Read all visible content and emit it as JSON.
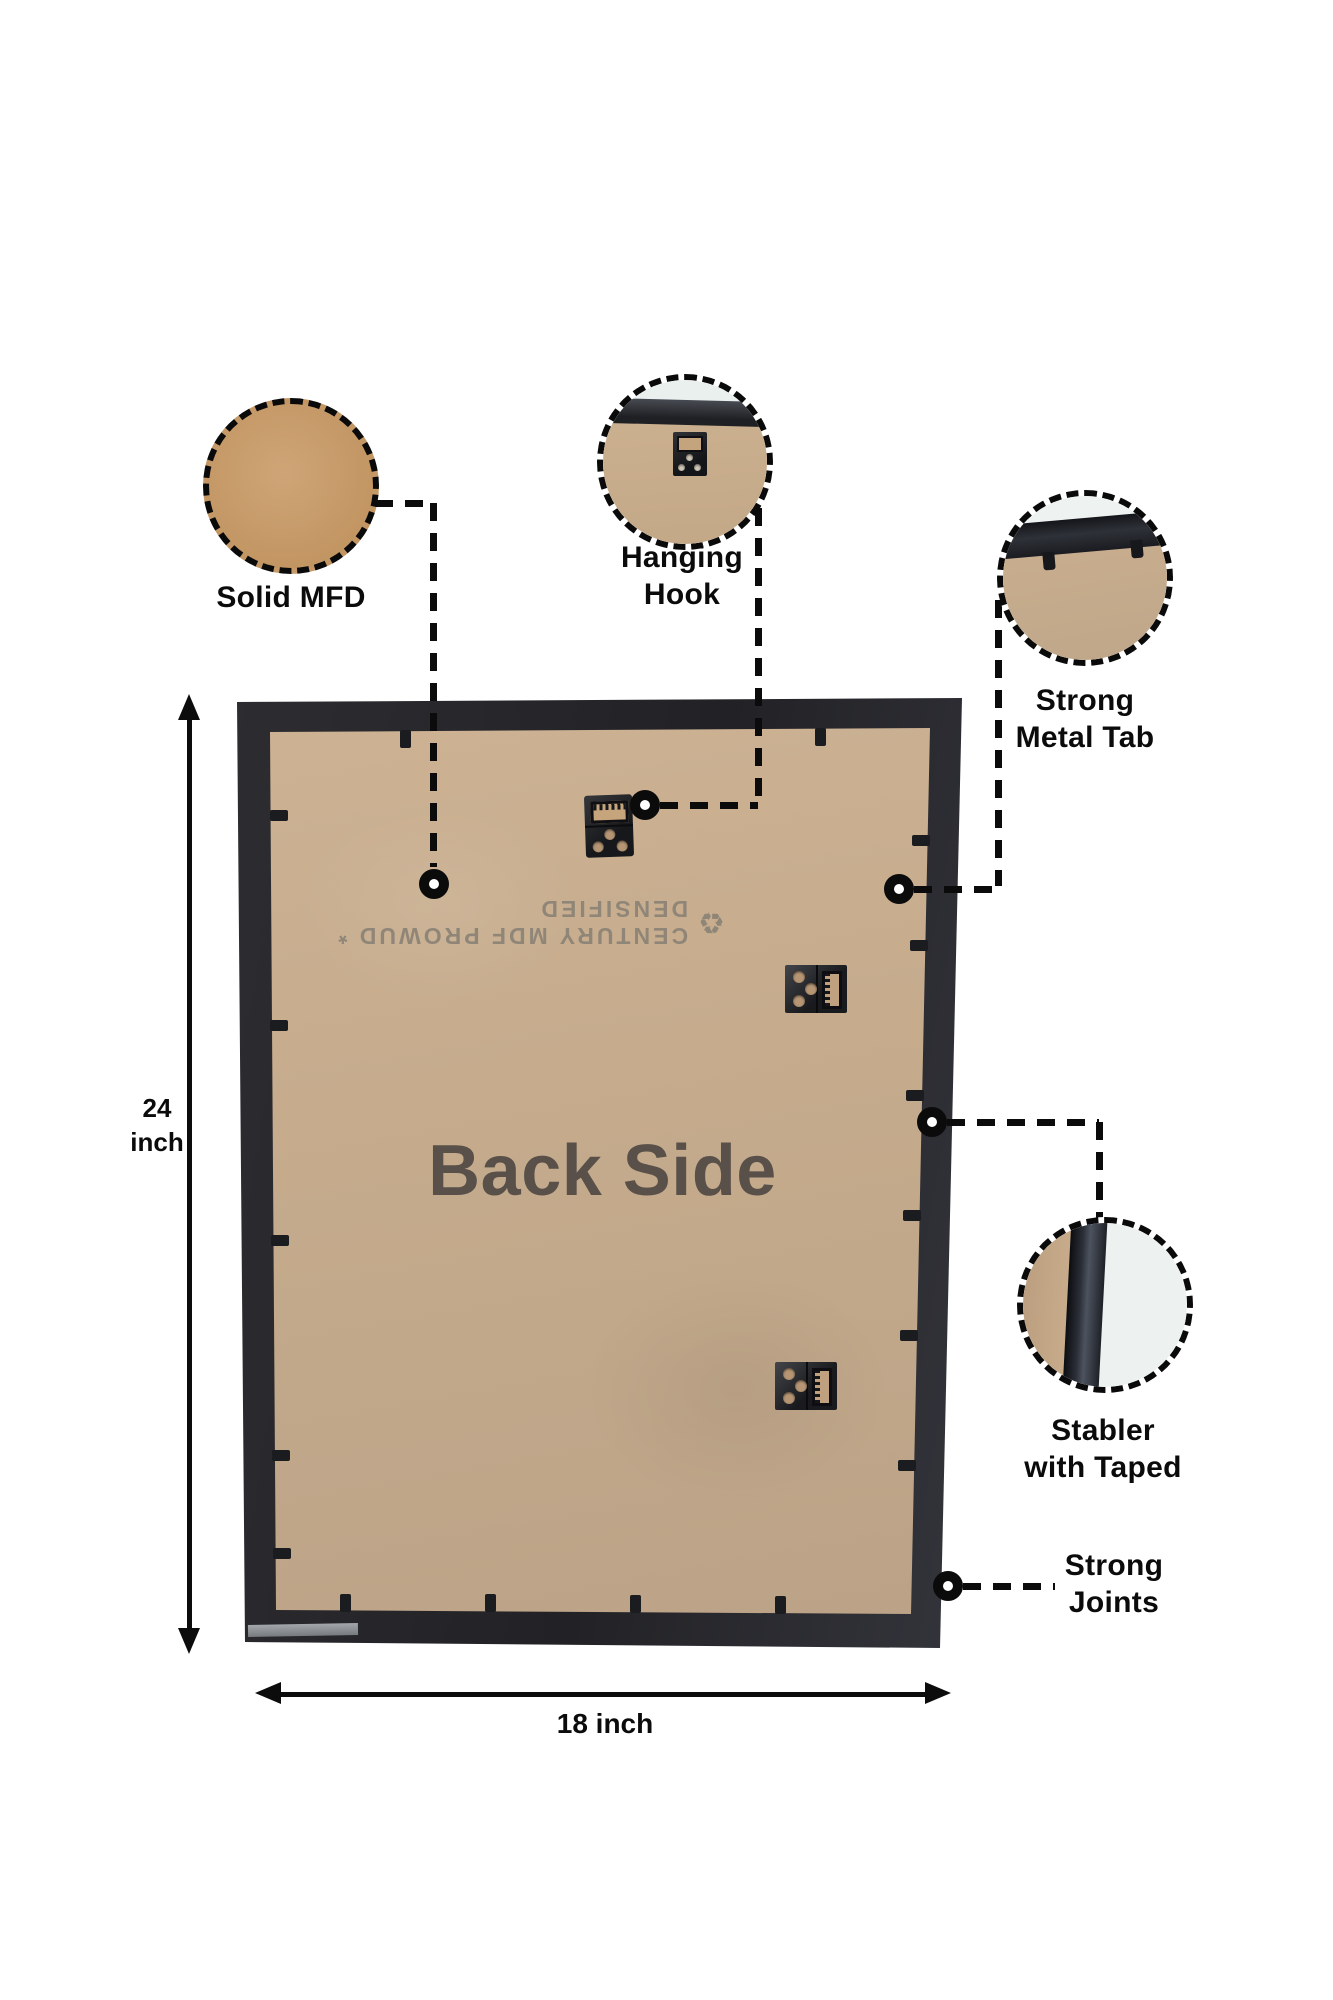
{
  "frame": {
    "board_title": "Back Side",
    "stamp_text": "CENTURY MDF PROWUD * DENSIFIED",
    "stamp_logo_glyph": "♻"
  },
  "callouts": {
    "solid_mfd": {
      "label": "Solid MFD"
    },
    "hanging_hook": {
      "label": "Hanging\nHook"
    },
    "strong_metal_tab": {
      "label": "Strong\nMetal Tab"
    },
    "stabler_with_taped": {
      "label": "Stabler\nwith Taped"
    },
    "strong_joints": {
      "label": "Strong\nJoints"
    }
  },
  "dimensions": {
    "height_label": "24\ninch",
    "width_label": "18 inch"
  },
  "colors": {
    "frame": "#232327",
    "mdf_board": "#c5ab8c",
    "mdf_swatch": "#c79e71",
    "annotation": "#0b0b0b",
    "board_title_text": "#585049",
    "stamp_text": "#8c8376",
    "wall_white": "#eef3f1"
  }
}
